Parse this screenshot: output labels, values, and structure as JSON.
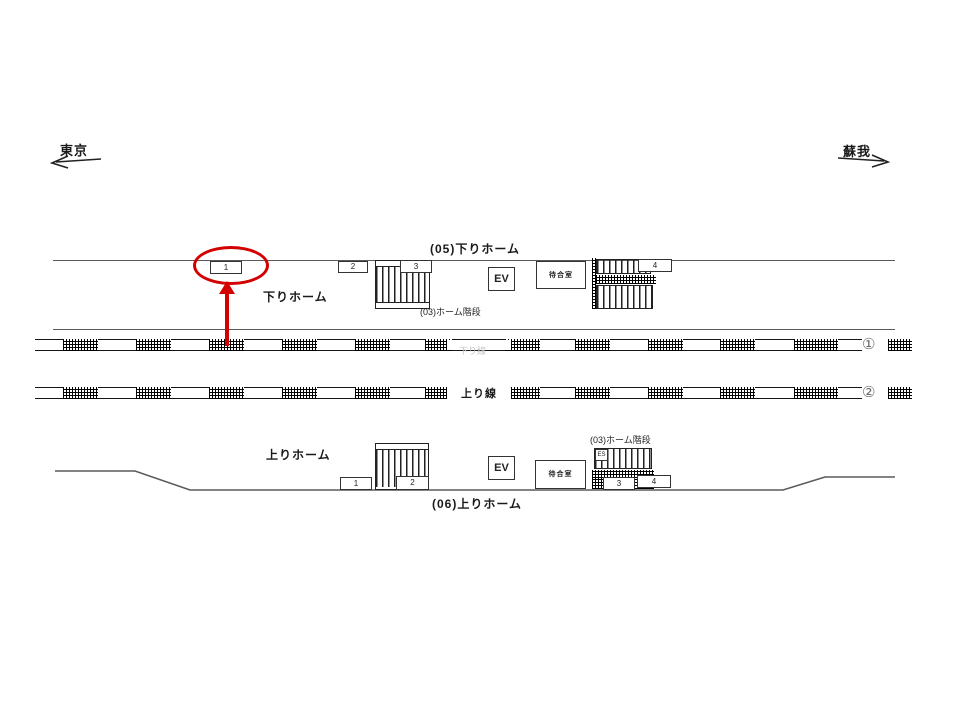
{
  "diagram": {
    "direction_left": "東京",
    "direction_right": "蘇我",
    "top_platform": {
      "title": "(05)下りホーム",
      "name": "下りホーム",
      "stairs_label": "(03)ホーム階段",
      "ev": "EV",
      "waiting_room": "待合室",
      "positions": {
        "p1": "1",
        "p2": "2",
        "p3": "3",
        "p4": "4"
      }
    },
    "bottom_platform": {
      "title": "(06)上りホーム",
      "name": "上りホーム",
      "stairs_label": "(03)ホーム階段",
      "ev": "EV",
      "waiting_room": "待合室",
      "escalator": "ES",
      "positions": {
        "p1": "1",
        "p2": "2",
        "p3": "3",
        "p4": "4"
      }
    },
    "tracks": {
      "track1_number": "①",
      "track2_number": "②",
      "up_line_label": "上り線",
      "down_line_label": "下り線"
    },
    "highlight": {
      "circled_position": "1"
    }
  },
  "colors": {
    "highlight_red": "#d40000",
    "platform_line_gray": "#5a5a5a",
    "track_black": "#161616"
  }
}
